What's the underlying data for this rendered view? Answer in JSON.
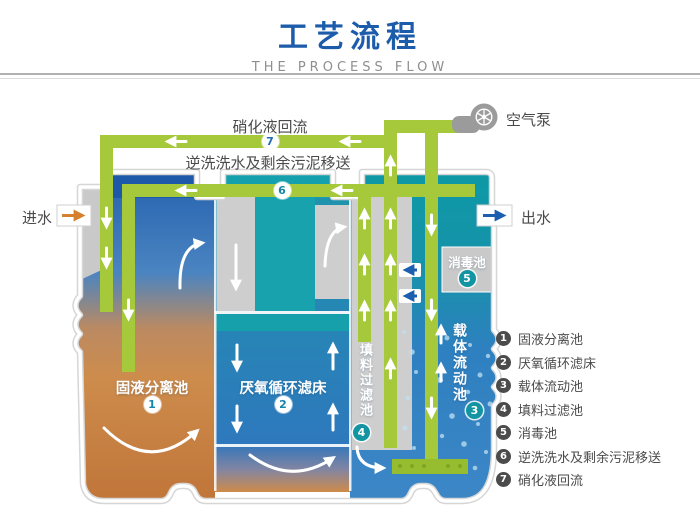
{
  "header": {
    "title": "工艺流程",
    "subtitle": "THE PROCESS FLOW"
  },
  "labels": {
    "recirculation": "硝化液回流",
    "backwash": "逆洗洗水及剩余污泥移送",
    "air_pump": "空气泵",
    "inlet": "进水",
    "outlet": "出水"
  },
  "tanks": {
    "t1": {
      "num": "1",
      "name": "固液分离池"
    },
    "t2": {
      "num": "2",
      "name": "厌氧循环滤床"
    },
    "t3": {
      "num": "3",
      "name": "载体流动池"
    },
    "t4": {
      "num": "4",
      "name": "填料过滤池"
    },
    "t5": {
      "num": "5",
      "name": "消毒池"
    }
  },
  "pipes": {
    "p6_num": "6",
    "p7_num": "7"
  },
  "legend": {
    "items": [
      {
        "num": "1",
        "label": "固液分离池"
      },
      {
        "num": "2",
        "label": "厌氧循环滤床"
      },
      {
        "num": "3",
        "label": "载体流动池"
      },
      {
        "num": "4",
        "label": "填料过滤池"
      },
      {
        "num": "5",
        "label": "消毒池"
      },
      {
        "num": "6",
        "label": "逆洗洗水及剩余污泥移送"
      },
      {
        "num": "7",
        "label": "硝化液回流"
      }
    ]
  },
  "colors": {
    "title_blue": "#1d5cab",
    "pipe_green": "#a5c93a",
    "teal": "#14a0ac",
    "tank_blue": "#2e78bd",
    "sludge_orange": "#cd8c4c",
    "structure_gray": "#cecece",
    "legend_text": "#4b4b4b"
  }
}
